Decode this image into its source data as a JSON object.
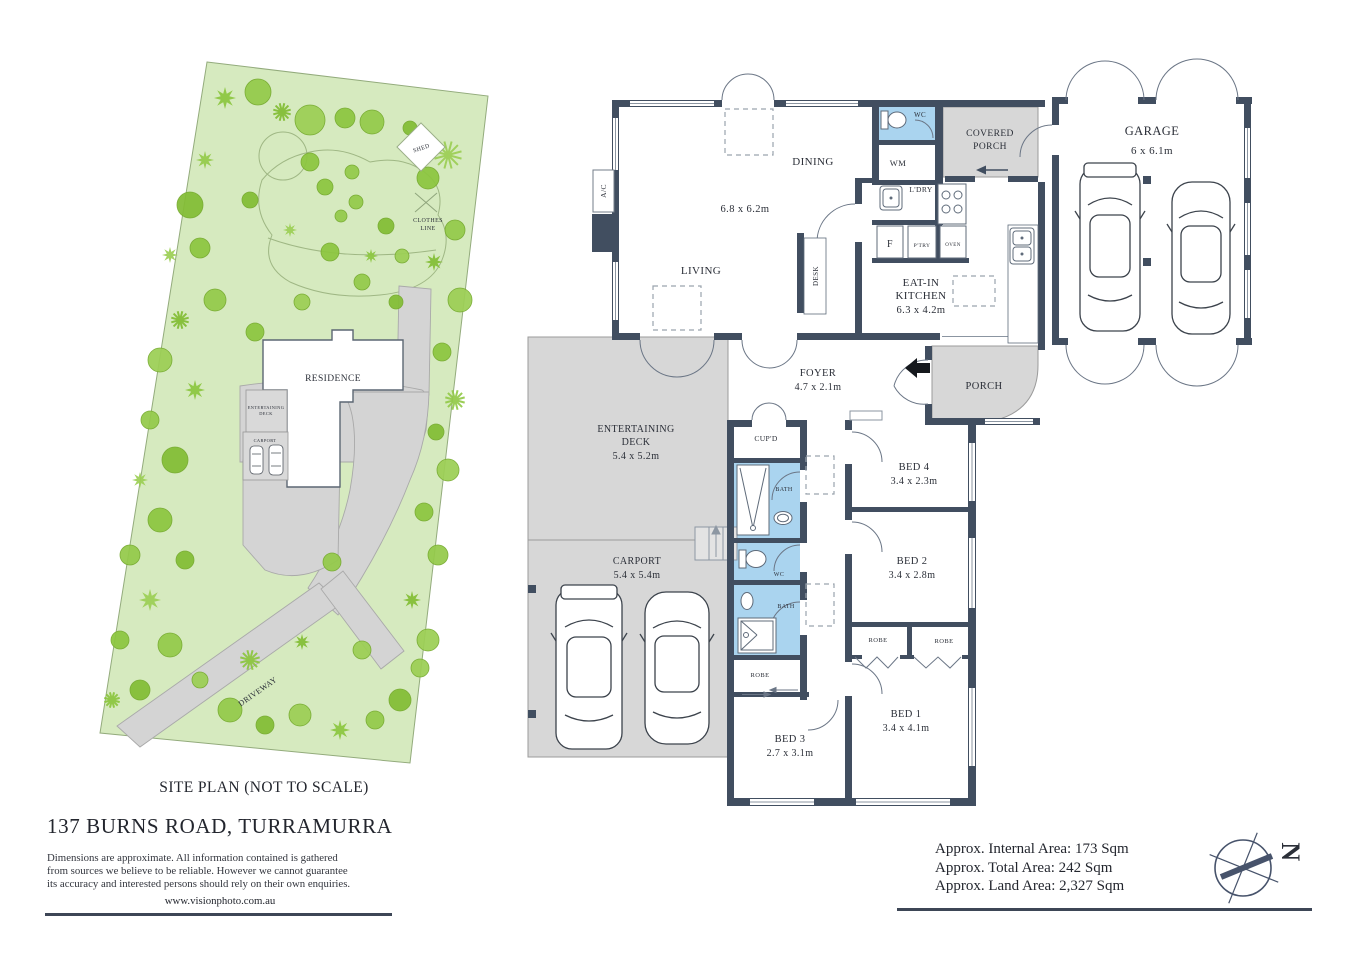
{
  "footer": {
    "caption": "SITE PLAN (NOT TO SCALE)",
    "address": "137 BURNS ROAD, TURRAMURRA",
    "disclaimer_line1": "Dimensions are approximate.  All  information contained is  gathered",
    "disclaimer_line2": "from sources we believe to be reliable.  However we cannot guarantee",
    "disclaimer_line3": "its accuracy and interested persons should rely on their own enquiries.",
    "website": "www.visionphoto.com.au"
  },
  "areas": {
    "internal": "Approx. Internal Area: 173 Sqm",
    "total": "Approx. Total Area: 242 Sqm",
    "land": "Approx. Land Area: 2,327 Sqm"
  },
  "compass": {
    "north": "N"
  },
  "site": {
    "shed": "SHED",
    "clothes_l1": "CLOTHES",
    "clothes_l2": "LINE",
    "residence": "RESIDENCE",
    "deck_l1": "ENTERTAINING",
    "deck_l2": "DECK",
    "carport": "CARPORT",
    "driveway": "DRIVEWAY"
  },
  "fp": {
    "living": "LIVING",
    "dining": "DINING",
    "living_dining_dim": "6.8 x 6.2m",
    "kitchen_l1": "EAT-IN",
    "kitchen_l2": "KITCHEN",
    "kitchen_dim": "6.3 x 4.2m",
    "wc_top": "WC",
    "wm": "WM",
    "ldry": "L'DRY",
    "fridge": "F",
    "ptry": "P'TRY",
    "oven": "OVEN",
    "desk": "DESK",
    "ac": "A/C",
    "covered_porch_l1": "COVERED",
    "covered_porch_l2": "PORCH",
    "garage": "GARAGE",
    "garage_dim": "6 x 6.1m",
    "foyer": "FOYER",
    "foyer_dim": "4.7 x 2.1m",
    "porch": "PORCH",
    "deck_l1": "ENTERTAINING",
    "deck_l2": "DECK",
    "deck_dim": "5.4 x 5.2m",
    "carport": "CARPORT",
    "carport_dim": "5.4 x 5.4m",
    "cupd": "CUP'D",
    "bath1": "BATH",
    "wc_mid": "WC",
    "bath2": "BATH",
    "robe_bed3": "ROBE",
    "robe_a": "ROBE",
    "robe_b": "ROBE",
    "bed1": "BED 1",
    "bed1_dim": "3.4 x 4.1m",
    "bed2": "BED 2",
    "bed2_dim": "3.4 x 2.8m",
    "bed3": "BED 3",
    "bed3_dim": "2.7 x 3.1m",
    "bed4": "BED 4",
    "bed4_dim": "3.4 x 2.3m"
  },
  "colors": {
    "wall": "#414e60",
    "bath_blue": "#aad4ef",
    "gray_area": "#d7d7d7",
    "site_green": "#d6eabf",
    "tree_green": "#8cc63f",
    "text": "#2b2f38"
  }
}
